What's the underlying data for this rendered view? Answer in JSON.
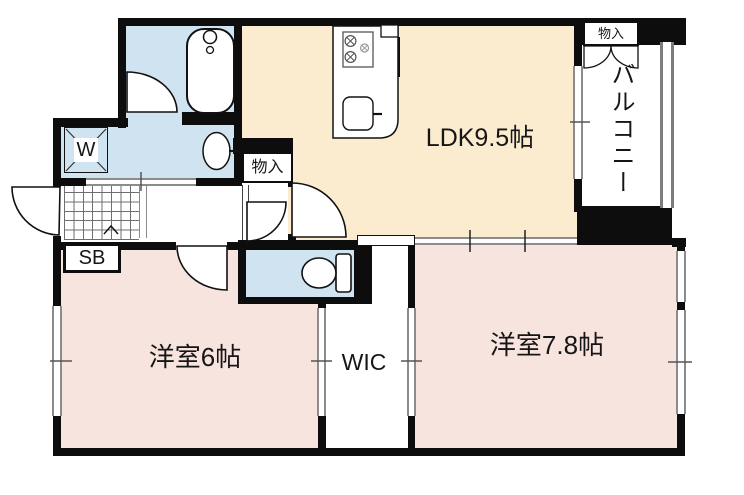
{
  "floor_plan": {
    "type": "apartment-floor-plan",
    "rooms": {
      "ldk": {
        "label": "LDK9.5帖",
        "size_jo": 9.5
      },
      "bedroom_6": {
        "label": "洋室6帖",
        "size_jo": 6
      },
      "bedroom_78": {
        "label": "洋室7.8帖",
        "size_jo": 7.8
      },
      "wic": {
        "label": "WIC"
      },
      "balcony": {
        "label": "バルコニー"
      }
    },
    "storage": {
      "hall_closet": {
        "label": "物入"
      },
      "balcony_closet": {
        "label": "物入"
      },
      "shoe_box": {
        "label": "SB"
      },
      "washer_space": {
        "label": "W"
      }
    },
    "fixtures": [
      "bathtub",
      "bath-faucet",
      "washing-machine-pan",
      "vanity-sink",
      "gas-stove",
      "kitchen-sink",
      "toilet",
      "entrance-tile-grid",
      "sliding-door-track",
      "balcony-railing"
    ],
    "colors": {
      "ldk_fill": "#fbeccf",
      "bedroom_fill": "#f8e4de",
      "wet_area_fill": "#cfe3f1",
      "wall": "#0d0d0d",
      "window_line": "#8c8c8c"
    }
  }
}
